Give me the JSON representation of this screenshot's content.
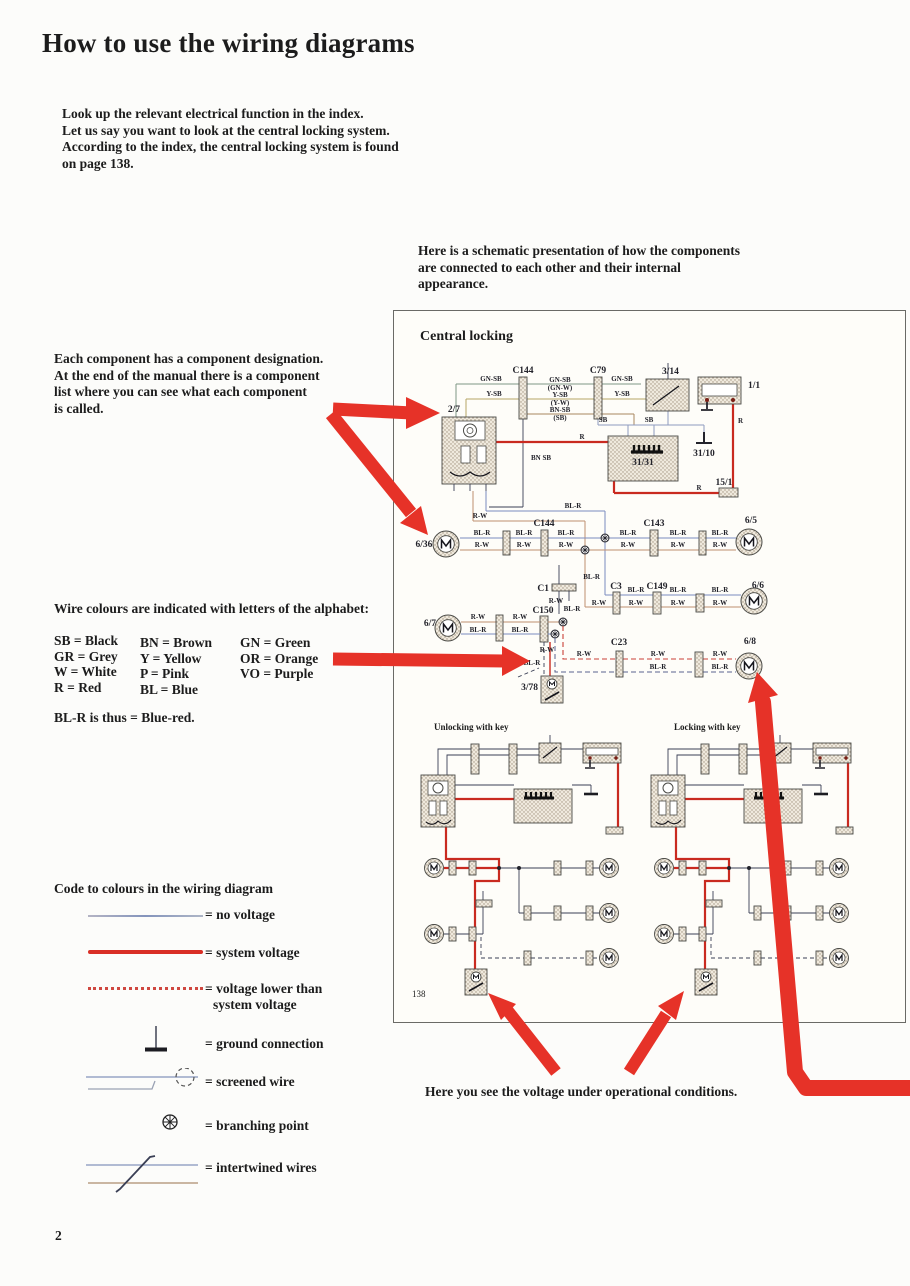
{
  "page": {
    "title": "How to use the wiring diagrams",
    "page_number": "2",
    "intro": [
      "Look up the relevant electrical function in the index.",
      "Let us say you want to look at the central locking system.",
      "According to the index, the central locking system is found",
      "on page 138."
    ],
    "schematic_note": [
      "Here is a schematic presentation of how the components",
      "are connected to each other and their internal",
      "appearance."
    ],
    "component_note": [
      "Each component has a component designation.",
      "At the end of the manual there is a component",
      "list where you can see what each component",
      "is called."
    ],
    "wire_colours_heading": "Wire colours are indicated with letters of the alphabet:",
    "colour_codes": {
      "col1": [
        "SB = Black",
        "GR = Grey",
        "W = White",
        "R = Red"
      ],
      "col2": [
        "BN = Brown",
        "Y = Yellow",
        "P = Pink",
        "BL = Blue"
      ],
      "col3": [
        "GN = Green",
        "OR = Orange",
        "VO = Purple"
      ]
    },
    "colour_example": "BL-R is thus = Blue-red.",
    "legend_heading": "Code to colours in the wiring diagram",
    "legend": [
      {
        "label": "= no voltage"
      },
      {
        "label": "= system voltage"
      },
      {
        "label": "= voltage lower than",
        "label2": "system voltage"
      },
      {
        "label": "= ground connection"
      },
      {
        "label": "= screened wire"
      },
      {
        "label": "= branching point"
      },
      {
        "label": "= intertwined wires"
      }
    ],
    "voltage_note": "Here you see the voltage under operational conditions."
  },
  "diagram": {
    "title": "Central locking",
    "page_ref": "138",
    "sub_left_title": "Unlocking with key",
    "sub_right_title": "Locking with key",
    "components": {
      "c144": "C144",
      "c79": "C79",
      "s314": "3/14",
      "f11": "1/1",
      "u27": "2/7",
      "b3131": "31/31",
      "g3110": "31/10",
      "t151": "15/1",
      "m636": "6/36",
      "c143": "C143",
      "m65": "6/5",
      "c1": "C1",
      "c150": "C150",
      "m67": "6/7",
      "c3": "C3",
      "c149": "C149",
      "m66": "6/6",
      "c23": "C23",
      "m68": "6/8",
      "u378": "3/78"
    },
    "wires": {
      "gnsb": "GN-SB",
      "ysb": "Y-SB",
      "gnw": "(GN-W)",
      "yw": "(Y-W)",
      "bnsb": "BN-SB",
      "sbp": "(SB)",
      "sb": "SB",
      "bnsb2": "BN SB",
      "r": "R",
      "blr": "BL-R",
      "rw": "R-W"
    }
  },
  "colors": {
    "arrow_red": "#e63228",
    "wire_red": "#c92a20",
    "wire_blue": "#7b8bc0"
  }
}
